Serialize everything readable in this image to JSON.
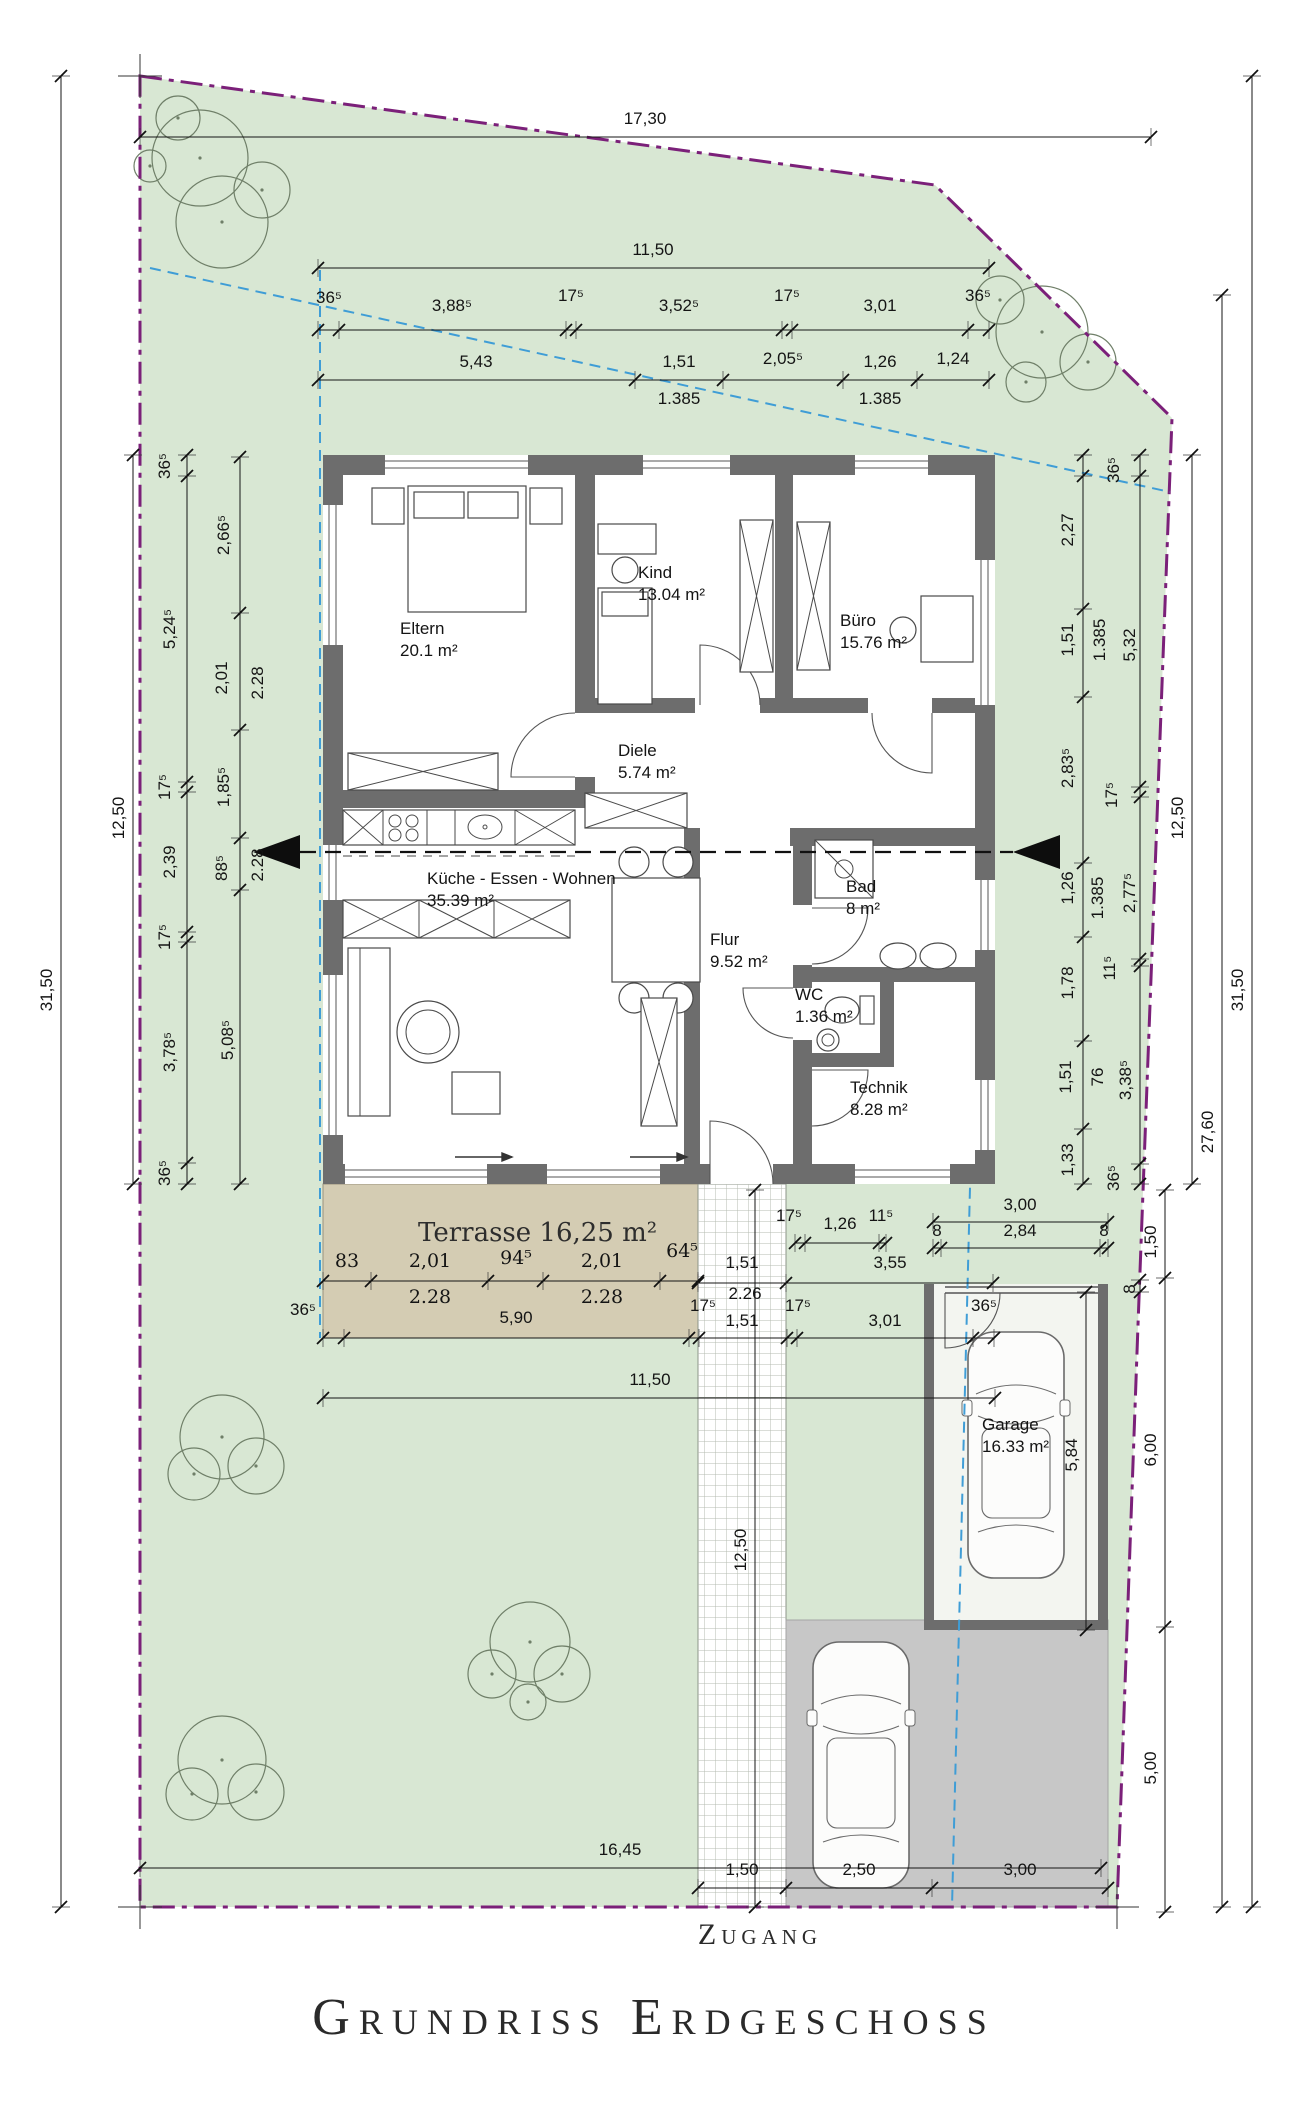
{
  "title": "Grundriss Erdgeschoss",
  "access_label": "Zugang",
  "terrace_label": "Terrasse 16,25 m²",
  "rooms": [
    {
      "id": "eltern",
      "name": "Eltern",
      "area": "20.1 m²",
      "x": 400,
      "y": 618
    },
    {
      "id": "kind",
      "name": "Kind",
      "area": "13.04 m²",
      "x": 638,
      "y": 562
    },
    {
      "id": "buero",
      "name": "Büro",
      "area": "15.76 m²",
      "x": 840,
      "y": 610
    },
    {
      "id": "diele",
      "name": "Diele",
      "area": "5.74 m²",
      "x": 618,
      "y": 740
    },
    {
      "id": "kueche",
      "name": "Küche - Essen - Wohnen",
      "area": "35.39 m²",
      "x": 427,
      "y": 868
    },
    {
      "id": "bad",
      "name": "Bad",
      "area": "8 m²",
      "x": 846,
      "y": 876
    },
    {
      "id": "flur",
      "name": "Flur",
      "area": "9.52 m²",
      "x": 710,
      "y": 929
    },
    {
      "id": "wc",
      "name": "WC",
      "area": "1.36 m²",
      "x": 795,
      "y": 984
    },
    {
      "id": "technik",
      "name": "Technik",
      "area": "8.28 m²",
      "x": 850,
      "y": 1077
    },
    {
      "id": "garage",
      "name": "Garage",
      "area": "16.33 m²",
      "x": 982,
      "y": 1414
    }
  ],
  "dim_chains": [
    {
      "o": "h",
      "c": 137,
      "s": 140,
      "e": 1151,
      "t": [
        140,
        1151
      ],
      "labels": [
        {
          "t": "17,30",
          "x": 645,
          "y": 119
        }
      ]
    },
    {
      "o": "h",
      "c": 268,
      "s": 318,
      "e": 989,
      "t": [
        318,
        989
      ],
      "labels": [
        {
          "t": "11,50",
          "x": 653,
          "y": 250
        }
      ]
    },
    {
      "o": "h",
      "c": 330,
      "s": 318,
      "e": 989,
      "t": [
        318,
        339,
        566,
        576,
        782,
        792,
        968,
        989
      ],
      "labels": [
        {
          "t": "36⁵",
          "x": 329,
          "y": 298
        },
        {
          "t": "3,88⁵",
          "x": 452,
          "y": 306
        },
        {
          "t": "17⁵",
          "x": 571,
          "y": 296
        },
        {
          "t": "3,52⁵",
          "x": 679,
          "y": 306
        },
        {
          "t": "17⁵",
          "x": 787,
          "y": 296
        },
        {
          "t": "3,01",
          "x": 880,
          "y": 306
        },
        {
          "t": "36⁵",
          "x": 978,
          "y": 296
        }
      ]
    },
    {
      "o": "h",
      "c": 380,
      "s": 318,
      "e": 989,
      "t": [
        318,
        635,
        723,
        843,
        917,
        989
      ],
      "labels": [
        {
          "t": "5,43",
          "x": 476,
          "y": 362
        },
        {
          "t": "1,51",
          "x": 679,
          "y": 362
        },
        {
          "t": "2,05⁵",
          "x": 783,
          "y": 359
        },
        {
          "t": "1,26",
          "x": 880,
          "y": 362
        },
        {
          "t": "1,24",
          "x": 953,
          "y": 359
        },
        {
          "t": "1.385",
          "x": 679,
          "y": 399
        },
        {
          "t": "1.385",
          "x": 880,
          "y": 399
        }
      ]
    },
    {
      "o": "h",
      "c": 1222,
      "s": 933,
      "e": 1108,
      "t": [
        933,
        1108
      ],
      "labels": [
        {
          "t": "3,00",
          "x": 1020,
          "y": 1205
        }
      ]
    },
    {
      "o": "h",
      "c": 1248,
      "s": 933,
      "e": 1108,
      "t": [
        933,
        941,
        1100,
        1108
      ],
      "labels": [
        {
          "t": "8",
          "x": 937,
          "y": 1231
        },
        {
          "t": "2,84",
          "x": 1020,
          "y": 1231
        },
        {
          "t": "8",
          "x": 1104,
          "y": 1231
        }
      ]
    },
    {
      "o": "h",
      "c": 1243,
      "s": 795,
      "e": 886,
      "t": [
        795,
        805,
        879,
        886
      ],
      "labels": [
        {
          "t": "17⁵",
          "x": 789,
          "y": 1216
        },
        {
          "t": "1,26",
          "x": 840,
          "y": 1224
        },
        {
          "t": "11⁵",
          "x": 881,
          "y": 1216
        }
      ]
    },
    {
      "o": "h",
      "c": 1283,
      "s": 698,
      "e": 993,
      "t": [
        698,
        786,
        993
      ],
      "labels": [
        {
          "t": "1,51",
          "x": 742,
          "y": 1263
        },
        {
          "t": "3,55",
          "x": 890,
          "y": 1263
        },
        {
          "t": "2.26",
          "x": 745,
          "y": 1294
        }
      ]
    },
    {
      "o": "h",
      "c": 1338,
      "s": 323,
      "e": 994,
      "t": [
        323,
        344,
        689,
        699,
        787,
        797,
        973,
        994
      ],
      "labels": [
        {
          "t": "36⁵",
          "x": 303,
          "y": 1310
        },
        {
          "t": "5,90",
          "x": 516,
          "y": 1318
        },
        {
          "t": "17⁵",
          "x": 703,
          "y": 1306
        },
        {
          "t": "1,51",
          "x": 742,
          "y": 1321
        },
        {
          "t": "17⁵",
          "x": 798,
          "y": 1306
        },
        {
          "t": "3,01",
          "x": 885,
          "y": 1321
        },
        {
          "t": "36⁵",
          "x": 984,
          "y": 1306
        }
      ]
    },
    {
      "o": "h",
      "c": 1398,
      "s": 323,
      "e": 995,
      "t": [
        323,
        995
      ],
      "labels": [
        {
          "t": "11,50",
          "x": 650,
          "y": 1380
        }
      ]
    },
    {
      "o": "h",
      "c": 1281,
      "s": 323,
      "e": 698,
      "t": [
        323,
        371,
        488,
        543,
        660,
        698
      ],
      "cls": "arch",
      "labels": [
        {
          "t": "83",
          "x": 347,
          "y": 1261
        },
        {
          "t": "2,01",
          "x": 430,
          "y": 1261
        },
        {
          "t": "94⁵",
          "x": 516,
          "y": 1258
        },
        {
          "t": "2,01",
          "x": 602,
          "y": 1261
        },
        {
          "t": "64⁵",
          "x": 682,
          "y": 1251
        },
        {
          "t": "2.28",
          "x": 430,
          "y": 1297
        },
        {
          "t": "2.28",
          "x": 602,
          "y": 1297
        }
      ]
    },
    {
      "o": "h",
      "c": 1868,
      "s": 140,
      "e": 1101,
      "t": [
        140,
        1101
      ],
      "labels": [
        {
          "t": "16,45",
          "x": 620,
          "y": 1850
        }
      ]
    },
    {
      "o": "h",
      "c": 1888,
      "s": 698,
      "e": 1108,
      "t": [
        698,
        786,
        932,
        1108
      ],
      "labels": [
        {
          "t": "1,50",
          "x": 742,
          "y": 1870
        },
        {
          "t": "2,50",
          "x": 859,
          "y": 1870
        },
        {
          "t": "3,00",
          "x": 1020,
          "y": 1870
        }
      ]
    },
    {
      "o": "v",
      "c": 61,
      "s": 76,
      "e": 1907,
      "t": [
        76,
        1907
      ],
      "labels": [
        {
          "t": "31,50",
          "x": 47,
          "y": 990,
          "r": 1
        }
      ]
    },
    {
      "o": "v",
      "c": 133,
      "s": 455,
      "e": 1184,
      "t": [
        455,
        1184
      ],
      "labels": [
        {
          "t": "12,50",
          "x": 119,
          "y": 818,
          "r": 1
        }
      ]
    },
    {
      "o": "v",
      "c": 187,
      "s": 455,
      "e": 1184,
      "t": [
        455,
        476,
        782,
        792,
        932,
        942,
        1163,
        1184
      ],
      "labels": [
        {
          "t": "36⁵",
          "x": 165,
          "y": 466,
          "r": 1
        },
        {
          "t": "5,24⁵",
          "x": 170,
          "y": 629,
          "r": 1
        },
        {
          "t": "17⁵",
          "x": 165,
          "y": 787,
          "r": 1
        },
        {
          "t": "2,39",
          "x": 170,
          "y": 862,
          "r": 1
        },
        {
          "t": "17⁵",
          "x": 165,
          "y": 937,
          "r": 1
        },
        {
          "t": "3,78⁵",
          "x": 170,
          "y": 1052,
          "r": 1
        },
        {
          "t": "36⁵",
          "x": 165,
          "y": 1173,
          "r": 1
        }
      ]
    },
    {
      "o": "v",
      "c": 240,
      "s": 457,
      "e": 1184,
      "t": [
        457,
        613,
        730,
        838,
        890,
        1184
      ],
      "labels": [
        {
          "t": "2,66⁵",
          "x": 224,
          "y": 535,
          "r": 1
        },
        {
          "t": "2,01",
          "x": 222,
          "y": 678,
          "r": 1
        },
        {
          "t": "2.28",
          "x": 258,
          "y": 683,
          "r": 1
        },
        {
          "t": "1,85⁵",
          "x": 224,
          "y": 787,
          "r": 1
        },
        {
          "t": "88⁵",
          "x": 222,
          "y": 868,
          "r": 1
        },
        {
          "t": "2.28",
          "x": 258,
          "y": 865,
          "r": 1
        },
        {
          "t": "5,08⁵",
          "x": 228,
          "y": 1040,
          "r": 1
        }
      ]
    },
    {
      "o": "v",
      "c": 1083,
      "s": 455,
      "e": 1184,
      "t": [
        455,
        476,
        609,
        697,
        863,
        937,
        1041,
        1129,
        1184
      ],
      "labels": [
        {
          "t": "2,27",
          "x": 1068,
          "y": 530,
          "r": 1
        },
        {
          "t": "1,51",
          "x": 1068,
          "y": 640,
          "r": 1
        },
        {
          "t": "1.385",
          "x": 1100,
          "y": 640,
          "r": 1
        },
        {
          "t": "2,83⁵",
          "x": 1068,
          "y": 768,
          "r": 1
        },
        {
          "t": "1,26",
          "x": 1068,
          "y": 888,
          "r": 1
        },
        {
          "t": "1.385",
          "x": 1098,
          "y": 898,
          "r": 1
        },
        {
          "t": "1,78",
          "x": 1068,
          "y": 983,
          "r": 1
        },
        {
          "t": "1,51",
          "x": 1066,
          "y": 1077,
          "r": 1
        },
        {
          "t": "76",
          "x": 1098,
          "y": 1077,
          "r": 1
        },
        {
          "t": "1,33",
          "x": 1068,
          "y": 1160,
          "r": 1
        }
      ]
    },
    {
      "o": "v",
      "c": 1140,
      "s": 455,
      "e": 1184,
      "t": [
        455,
        476,
        787,
        797,
        959,
        966,
        1164,
        1184
      ],
      "labels": [
        {
          "t": "36⁵",
          "x": 1114,
          "y": 470,
          "r": 1
        },
        {
          "t": "5,32",
          "x": 1130,
          "y": 645,
          "r": 1
        },
        {
          "t": "17⁵",
          "x": 1112,
          "y": 795,
          "r": 1
        },
        {
          "t": "2,77⁵",
          "x": 1130,
          "y": 893,
          "r": 1
        },
        {
          "t": "11⁵",
          "x": 1110,
          "y": 968,
          "r": 1
        },
        {
          "t": "3,38⁵",
          "x": 1126,
          "y": 1080,
          "r": 1
        },
        {
          "t": "36⁵",
          "x": 1114,
          "y": 1178,
          "r": 1
        }
      ]
    },
    {
      "o": "v",
      "c": 1192,
      "s": 455,
      "e": 1184,
      "t": [
        455,
        1184
      ],
      "labels": [
        {
          "t": "12,50",
          "x": 1178,
          "y": 818,
          "r": 1
        }
      ]
    },
    {
      "o": "v",
      "c": 1222,
      "s": 295,
      "e": 1907,
      "t": [
        295,
        1907
      ],
      "labels": [
        {
          "t": "27,60",
          "x": 1208,
          "y": 1132,
          "r": 1
        }
      ]
    },
    {
      "o": "v",
      "c": 1252,
      "s": 76,
      "e": 1907,
      "t": [
        76,
        1907
      ],
      "labels": [
        {
          "t": "31,50",
          "x": 1238,
          "y": 990,
          "r": 1
        }
      ]
    },
    {
      "o": "v",
      "c": 1165,
      "s": 1190,
      "e": 1912,
      "t": [
        1190,
        1278,
        1627,
        1912
      ],
      "labels": [
        {
          "t": "1,50",
          "x": 1151,
          "y": 1242,
          "r": 1
        },
        {
          "t": "6,00",
          "x": 1151,
          "y": 1450,
          "r": 1
        },
        {
          "t": "5,00",
          "x": 1151,
          "y": 1768,
          "r": 1
        }
      ]
    },
    {
      "o": "v",
      "c": 1086,
      "s": 1292,
      "e": 1630,
      "t": [
        1292,
        1630
      ],
      "labels": [
        {
          "t": "5,84",
          "x": 1072,
          "y": 1455,
          "r": 1
        }
      ]
    },
    {
      "o": "v",
      "c": 1140,
      "s": 1280,
      "e": 1292,
      "t": [
        1280,
        1292
      ],
      "labels": [
        {
          "t": "8",
          "x": 1130,
          "y": 1289,
          "r": 1
        }
      ]
    },
    {
      "o": "v",
      "c": 755,
      "s": 1190,
      "e": 1907,
      "t": [
        1190,
        1907
      ],
      "labels": [
        {
          "t": "12,50",
          "x": 741,
          "y": 1550,
          "r": 1
        }
      ]
    }
  ],
  "trees": [
    {
      "c": [
        [
          200,
          158,
          48
        ],
        [
          222,
          222,
          46
        ],
        [
          262,
          190,
          28
        ],
        [
          150,
          166,
          16
        ],
        [
          178,
          118,
          22
        ]
      ]
    },
    {
      "c": [
        [
          1042,
          332,
          46
        ],
        [
          1000,
          300,
          24
        ],
        [
          1088,
          362,
          28
        ],
        [
          1026,
          382,
          20
        ]
      ]
    },
    {
      "c": [
        [
          222,
          1437,
          42
        ],
        [
          194,
          1474,
          26
        ],
        [
          256,
          1466,
          28
        ]
      ]
    },
    {
      "c": [
        [
          530,
          1642,
          40
        ],
        [
          492,
          1674,
          24
        ],
        [
          562,
          1674,
          28
        ],
        [
          528,
          1702,
          18
        ]
      ]
    },
    {
      "c": [
        [
          222,
          1760,
          44
        ],
        [
          192,
          1794,
          26
        ],
        [
          256,
          1792,
          28
        ]
      ]
    }
  ],
  "colors": {
    "site_green": "#d8e7d3",
    "boundary_purple": "#7b2079",
    "setback_blue": "#3f9dd6",
    "wall_gray": "#6d6d6d",
    "terrace_tan": "#d4ccb3",
    "parking_gray": "#c7c7c7",
    "dimension_black": "#141414"
  }
}
